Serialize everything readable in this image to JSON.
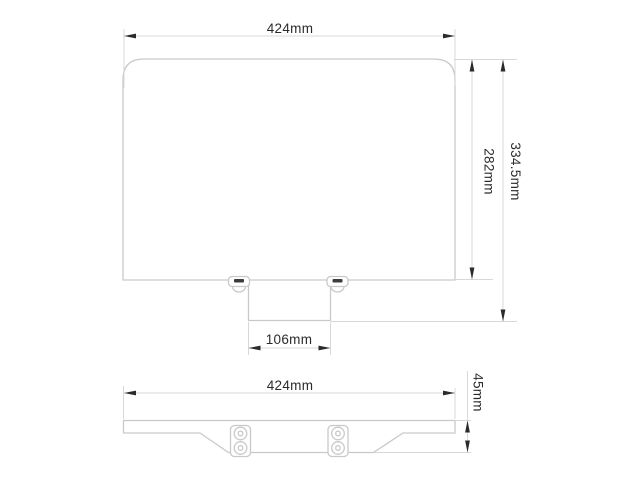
{
  "diagram": {
    "kind": "technical-dimension-drawing",
    "colors": {
      "background": "#ffffff",
      "outline": "#c9c9c9",
      "dimension_line": "#d8d8d8",
      "text": "#2b2b2b",
      "slot": "#3c3c3c"
    },
    "top_view": {
      "dimensions": {
        "width": {
          "label": "424mm"
        },
        "panel_height": {
          "label": "282mm"
        },
        "overall_height": {
          "label": "334.5mm"
        },
        "bracket_width": {
          "label": "106mm"
        }
      }
    },
    "front_view": {
      "dimensions": {
        "width": {
          "label": "424mm"
        },
        "height": {
          "label": "45mm"
        }
      }
    }
  }
}
